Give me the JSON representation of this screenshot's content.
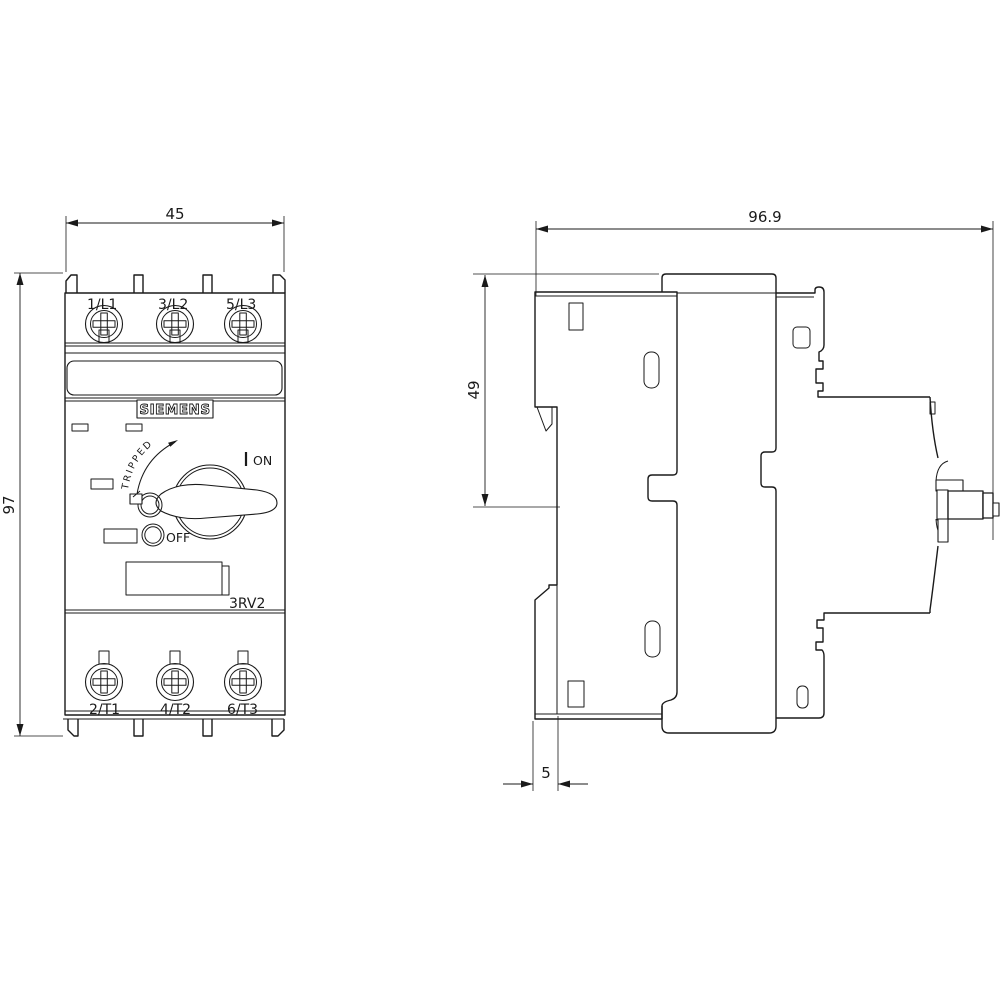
{
  "colors": {
    "line": "#1a1a1a",
    "background": "#ffffff"
  },
  "front_view": {
    "dim_width": "45",
    "dim_height": "97",
    "brand": "SIEMENS",
    "model": "3RV2",
    "terminals_top": [
      "1/L1",
      "3/L2",
      "5/L3"
    ],
    "terminals_bottom": [
      "2/T1",
      "4/T2",
      "6/T3"
    ],
    "switch": {
      "on": "ON",
      "off": "OFF",
      "tripped": "TRIPPED"
    }
  },
  "side_view": {
    "dim_depth": "96.9",
    "dim_rail_height": "49",
    "dim_clip_depth": "5"
  }
}
